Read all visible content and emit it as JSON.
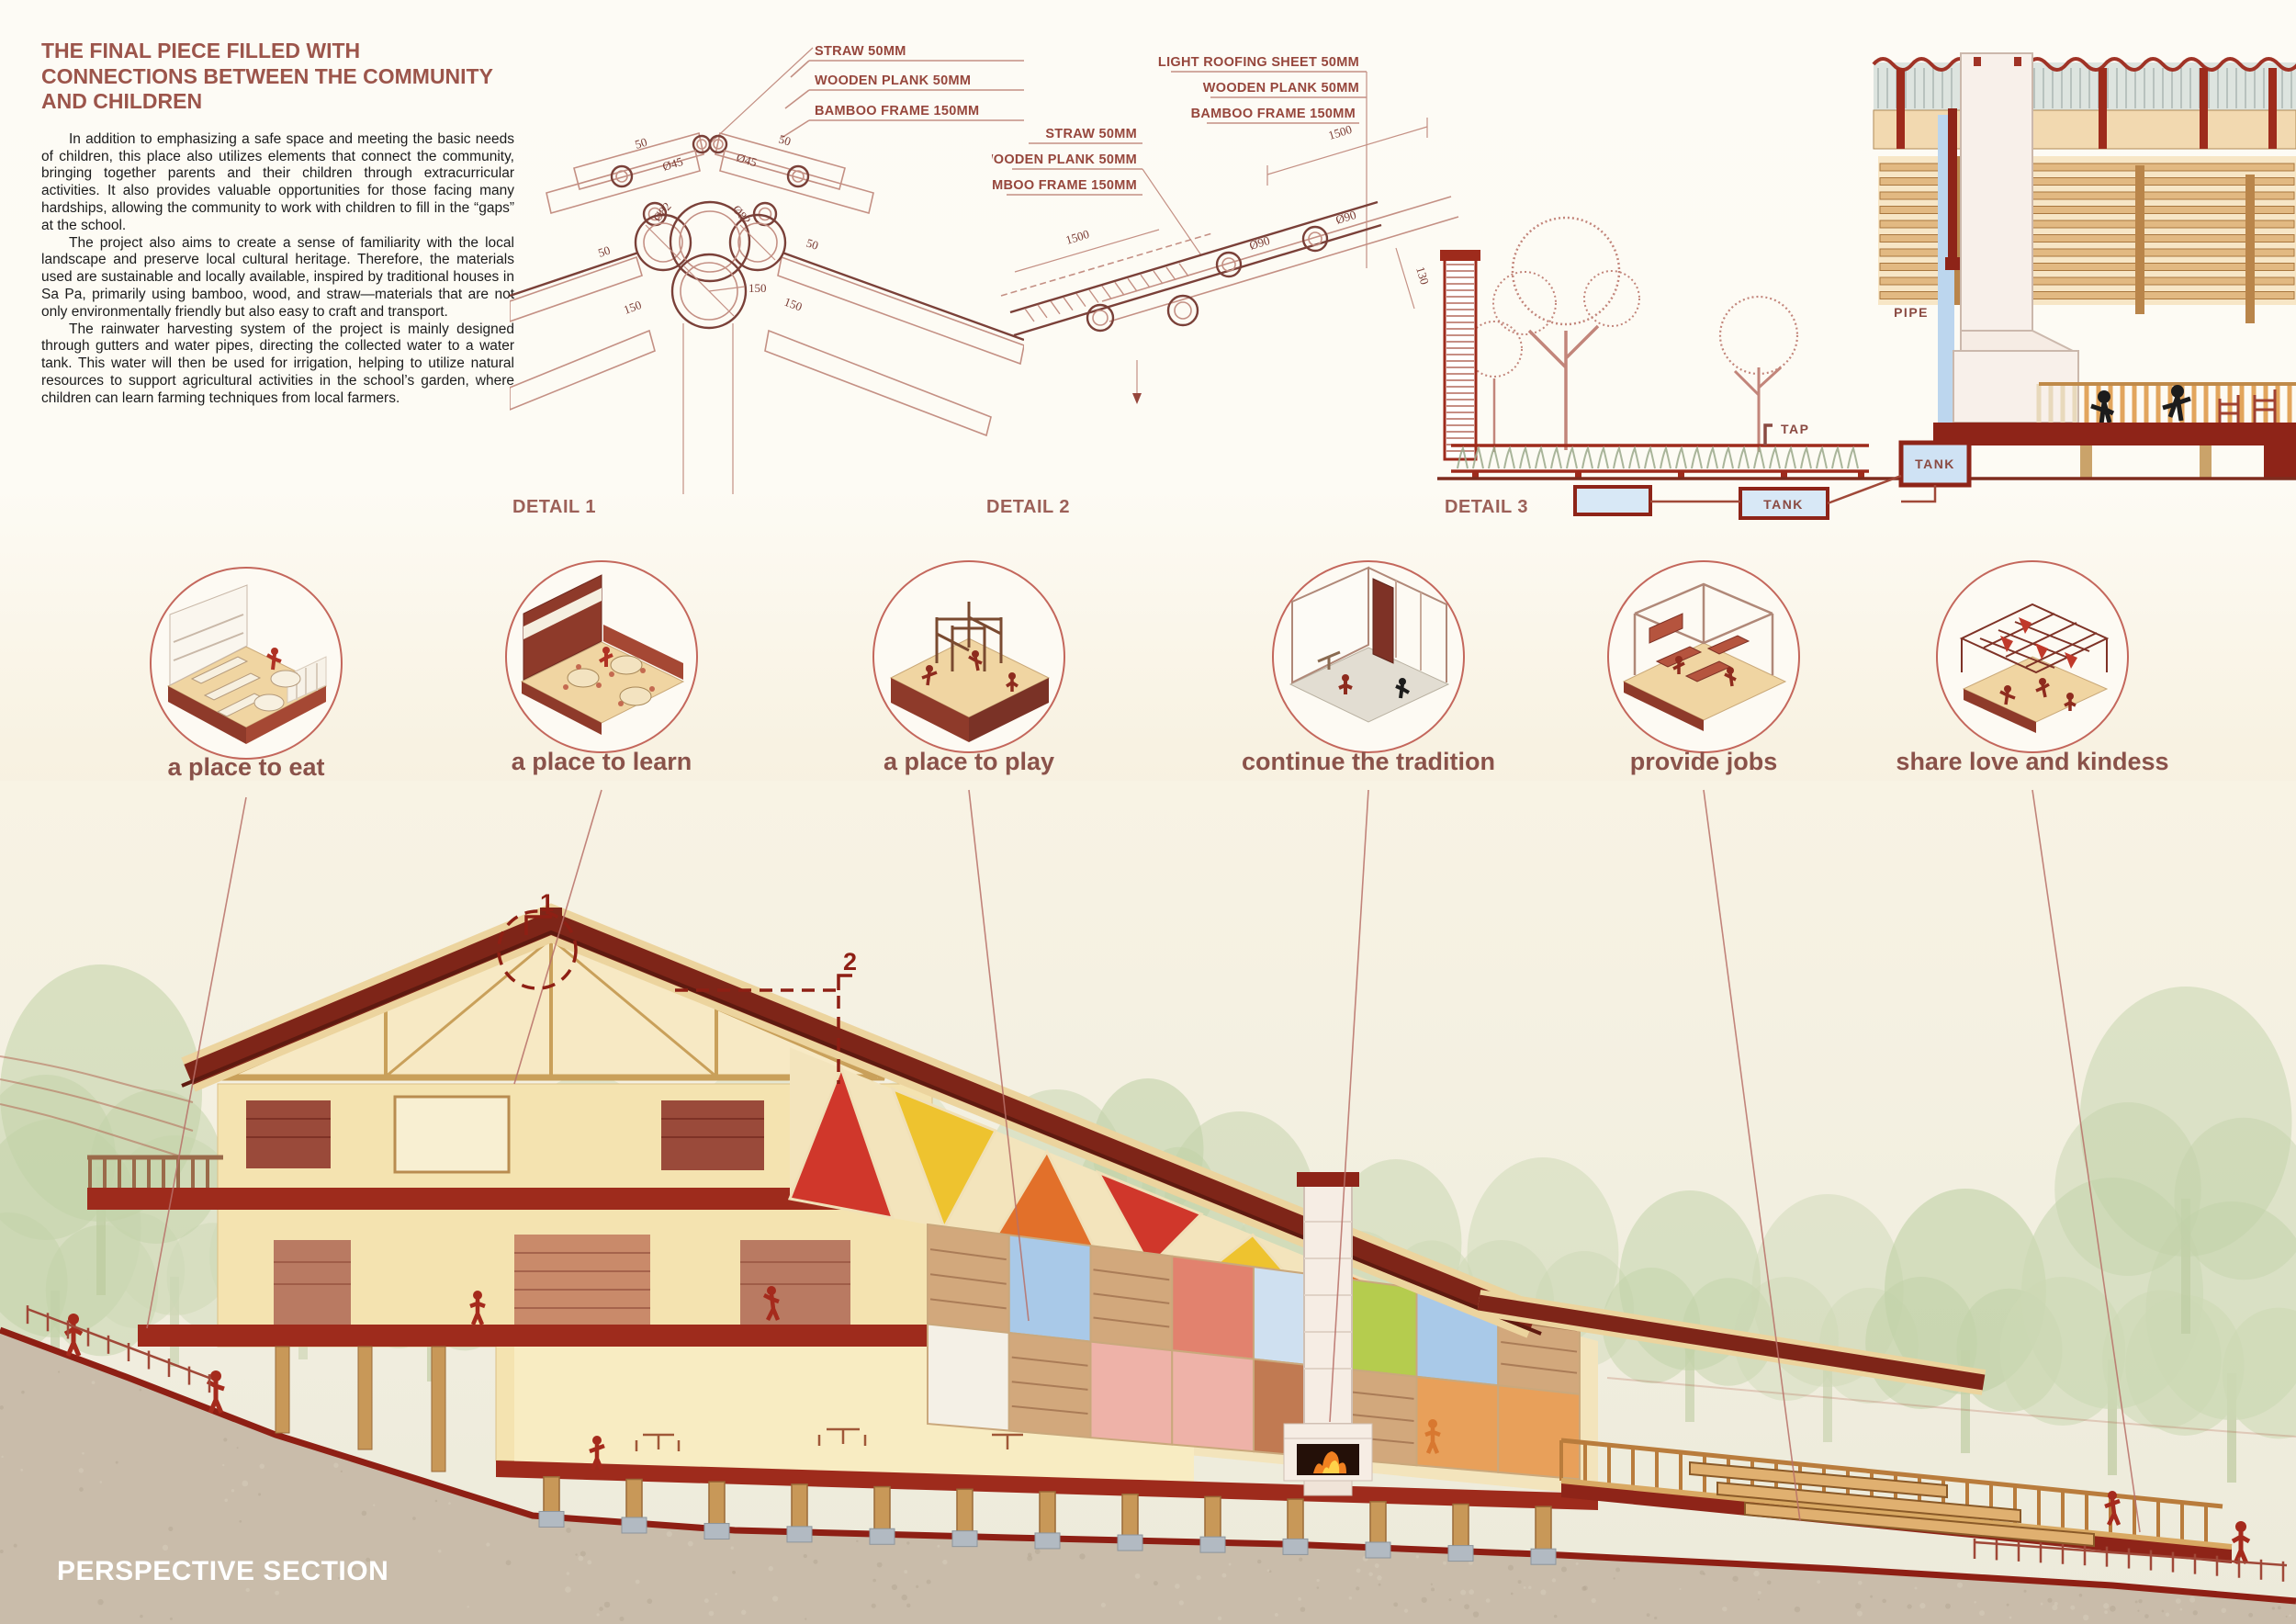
{
  "intro": {
    "title": "THE FINAL PIECE FILLED WITH CONNECTIONS BETWEEN THE COMMUNITY AND CHILDREN",
    "para1": "In addition to emphasizing a safe space and meeting the basic needs of children, this place also utilizes elements that connect the community, bringing together parents and their children through extracurricular activities. It also provides valuable opportunities for those facing many hardships, allowing the community to work with children to fill in the “gaps” at the school.",
    "para2": "The project also aims to create a sense of familiarity with the local landscape and preserve local cultural heritage. Therefore, the materials used are sustainable and locally available, inspired by traditional houses in Sa Pa, primarily using bamboo, wood, and straw—materials that are not only environmentally friendly but also easy to craft and transport.",
    "para3": "The rainwater harvesting system of the project is mainly designed through gutters and water pipes, directing the collected water to a water tank. This water will then be used for irrigation, helping to utilize natural resources to support agricultural activities in the school’s garden, where children can learn farming techniques from local farmers."
  },
  "detail1": {
    "label": "DETAIL 1",
    "callouts": [
      "STRAW 50MM",
      "WOODEN PLANK 50MM",
      "BAMBOO FRAME 150MM"
    ],
    "dims": {
      "top_left": "50",
      "top_right": "50",
      "phi45_left": "Ø45",
      "phi45_right": "Ø45",
      "phi82_left": "Ø82",
      "phi82_right": "Ø82",
      "mid_left": "50",
      "mid_right": "50",
      "center": "150",
      "low_left": "150",
      "low_right": "150"
    }
  },
  "detail2": {
    "label": "DETAIL 2",
    "callouts_top": [
      "LIGHT ROOFING SHEET 50MM",
      "WOODEN PLANK 50MM",
      "BAMBOO FRAME 150MM"
    ],
    "callouts_side": [
      "STRAW 50MM",
      "WOODEN PLANK 50MM",
      "BAMBOO FRAME 150MM"
    ],
    "dims": {
      "top": "1500",
      "left": "1500",
      "phi90_upper": "Ø90",
      "phi90_lower": "Ø90",
      "right": "130"
    }
  },
  "detail3": {
    "label": "DETAIL 3",
    "pipe": "PIPE",
    "tap": "TAP",
    "tank_main": "TANK",
    "tank_buried": "TANK"
  },
  "concepts": [
    {
      "label": "a place to eat"
    },
    {
      "label": "a place to learn"
    },
    {
      "label": "a place to play"
    },
    {
      "label": "continue the tradition"
    },
    {
      "label": "provide jobs"
    },
    {
      "label": "share love and kindess"
    }
  ],
  "perspective": {
    "label": "PERSPECTIVE SECTION",
    "marker1": "1",
    "marker2": "2"
  },
  "palette": {
    "triangles": [
      "#d0372b",
      "#eec32f",
      "#e2702a"
    ],
    "checker": [
      "#eadcc4",
      "#e2826e",
      "#d84b3c",
      "#76a3d6",
      "#a9c9e8",
      "#b5cc4e",
      "#e8a05a",
      "#f4f0e6",
      "#eeb2a8",
      "#c17a52",
      "#e7d7b2",
      "#cfe0f0"
    ],
    "accent_red": "#8e1f14",
    "wood": "#c89858",
    "cream_wall": "#f4e3b0",
    "tree_green": "#ccd8b4",
    "ground": "#c9bcaa"
  }
}
